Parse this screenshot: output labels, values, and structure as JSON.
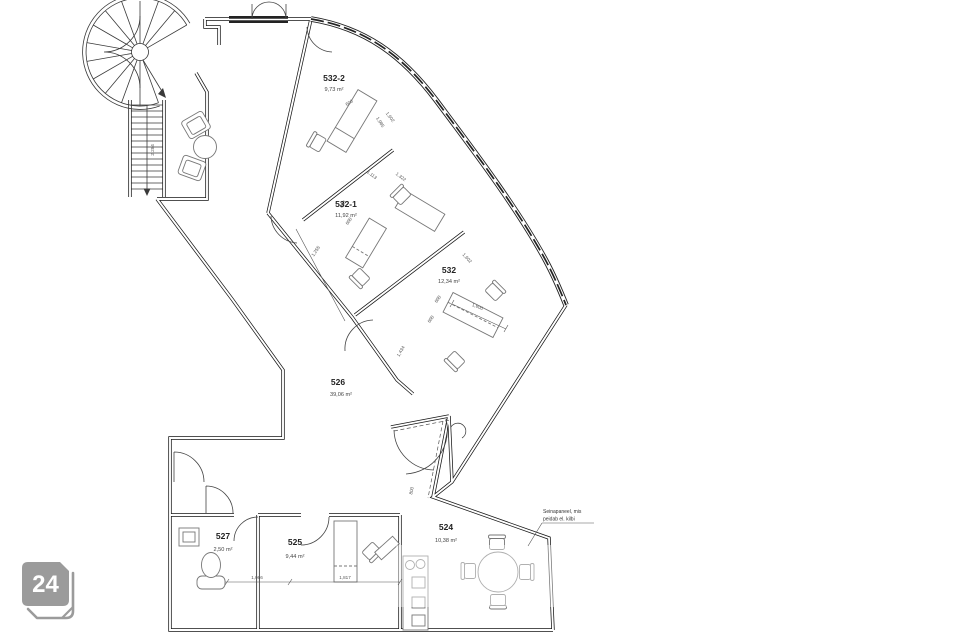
{
  "page": {
    "background": "#ffffff"
  },
  "logo": {
    "text": "24",
    "color": "#9b9b9b"
  },
  "plan": {
    "rooms": [
      {
        "id": "532-2",
        "area": "9,73 m²"
      },
      {
        "id": "532-1",
        "area": "11,92 m²"
      },
      {
        "id": "532",
        "area": "12,34 m²"
      },
      {
        "id": "526",
        "area": "39,06 m²"
      },
      {
        "id": "527",
        "area": "2,50 m²"
      },
      {
        "id": "525",
        "area": "9,44 m²"
      },
      {
        "id": "524",
        "area": "10,38 m²"
      }
    ],
    "note": {
      "line1": "Seinapaneel, mis",
      "line2": "peidab el. kilbi"
    },
    "dims": [
      "600",
      "1,985",
      "1,113",
      "1,322",
      "600",
      "600",
      "1,255",
      "1,602",
      "1,602",
      "600",
      "600",
      "1,600",
      "1,434",
      "800",
      "1,066",
      "1,817",
      "2.284"
    ],
    "colors": {
      "wall": "#161616",
      "furniture": "#777777",
      "dimension": "#555555",
      "glazing": "#222222"
    }
  }
}
